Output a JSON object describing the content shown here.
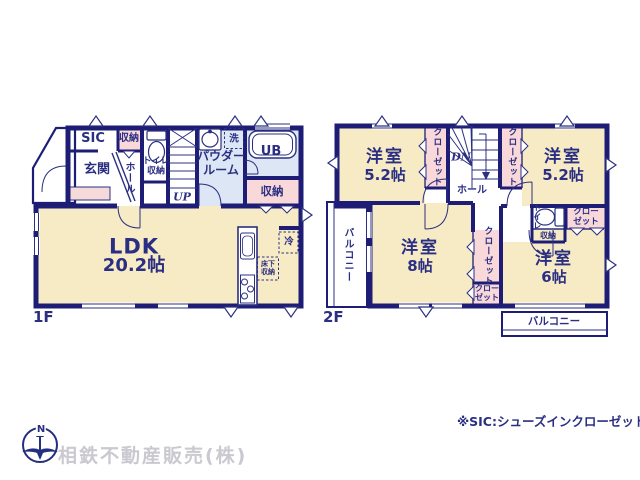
{
  "page": {
    "floor1_label": "1F",
    "floor2_label": "2F",
    "note": "※SIC:シューズインクローゼット",
    "company": "相鉄不動産販売(株)",
    "compass_north": "N"
  },
  "floor1": {
    "sic": "SIC",
    "storage_top": "収納",
    "genkan": "玄関",
    "hall": "ホール",
    "toilet_l1": "トイレ",
    "toilet_l2": "収納",
    "stairs": "UP",
    "powder_l1": "パウダー",
    "powder_l2": "ルーム",
    "laundry": "洗",
    "bath": "UB",
    "storage_bath": "収納",
    "ldk_name": "LDK",
    "ldk_size": "20.2帖",
    "fridge": "冷",
    "underfloor_l1": "床下",
    "underfloor_l2": "収納"
  },
  "floor2": {
    "bed1_name": "洋室",
    "bed1_size": "5.2帖",
    "bed2_name": "洋室",
    "bed2_size": "5.2帖",
    "bed3_name": "洋室",
    "bed3_size": "8帖",
    "bed4_name": "洋室",
    "bed4_size": "6帖",
    "closet1": "クローゼット",
    "closet2": "クローゼット",
    "closet3": "クローゼット",
    "closet4_l1": "クロー",
    "closet4_l2": "ゼット",
    "closet5_l1": "クロー",
    "closet5_l2": "ゼット",
    "stairs": "DN",
    "hall": "ホール",
    "toilet": "トイレ",
    "storage": "収納",
    "balcony_left": "バルコニー",
    "balcony_bottom": "バルコニー"
  }
}
